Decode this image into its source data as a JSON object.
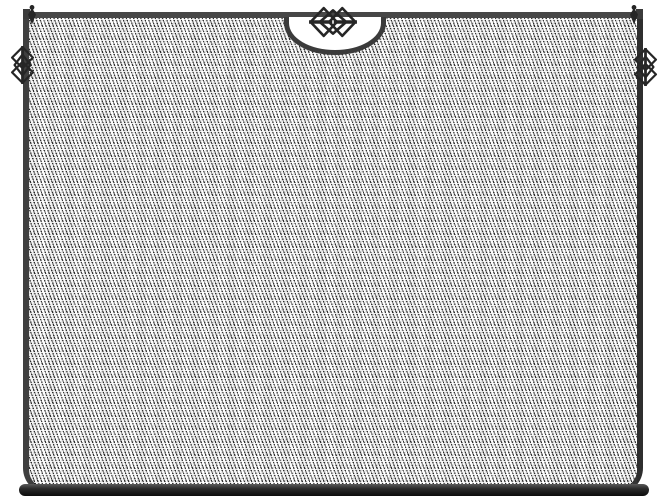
{
  "image": {
    "kind": "product-photo",
    "subject": "Flat black wrought-iron fireplace screen with fine woven wire mesh, a scalloped half-moon notch at the top centre crowned by a birdcage knot ornament, matching cage ornaments and pointed finials on the top corners, and a heavy rounded base bar",
    "background_description": "plain white backdrop"
  },
  "colors": {
    "background": "#ffffff",
    "frame": "#3b3b3b",
    "frame-dark": "#111111",
    "mesh-line": "#2e2e2e",
    "ornament": "#262626"
  },
  "parts": {
    "frame": "rectangular frame with rounded bottom corners",
    "mesh": "diagonal woven wire mesh panel",
    "notch": "half-moon scallop at top centre",
    "center_ornament": "birdcage diamond knot",
    "corner_ornaments": "vertical birdcage knots on left and right posts",
    "finials": "pointed diamond finials on corner posts",
    "base": "black rounded base bar"
  }
}
